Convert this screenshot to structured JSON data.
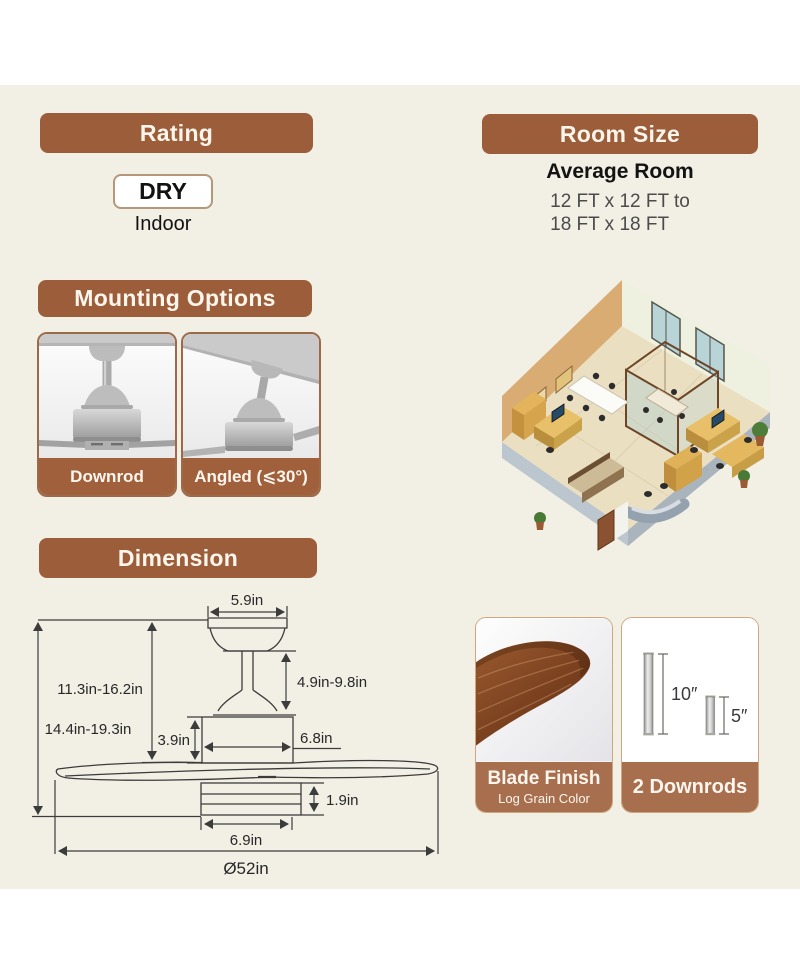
{
  "page": {
    "background_color": "#ffffff",
    "panel_color": "#f2efe5",
    "accent_color": "#9c5e3a",
    "card_label_color": "#a76f4e"
  },
  "rating": {
    "header": "Rating",
    "badge": "DRY",
    "sublabel": "Indoor"
  },
  "room_size": {
    "header": "Room Size",
    "subtitle": "Average Room",
    "line1": "12 FT x 12 FT to",
    "line2": "18 FT x 18 FT"
  },
  "mounting": {
    "header": "Mounting Options",
    "options": [
      {
        "label": "Downrod"
      },
      {
        "label": "Angled (⩽30°)"
      }
    ]
  },
  "dimension": {
    "header": "Dimension",
    "labels": {
      "canopy_width": "5.9in",
      "downrod_range": "4.9in-9.8in",
      "upper_height": "11.3in-16.2in",
      "total_height": "14.4in-19.3in",
      "motor_height": "3.9in",
      "motor_width": "6.8in",
      "light_height": "1.9in",
      "light_width": "6.9in",
      "blade_span": "Ø52in"
    }
  },
  "blade_finish": {
    "label": "Blade Finish",
    "sublabel": "Log Grain Color"
  },
  "downrods": {
    "label": "2 Downrods",
    "long_label": "10″",
    "short_label": "5″"
  }
}
